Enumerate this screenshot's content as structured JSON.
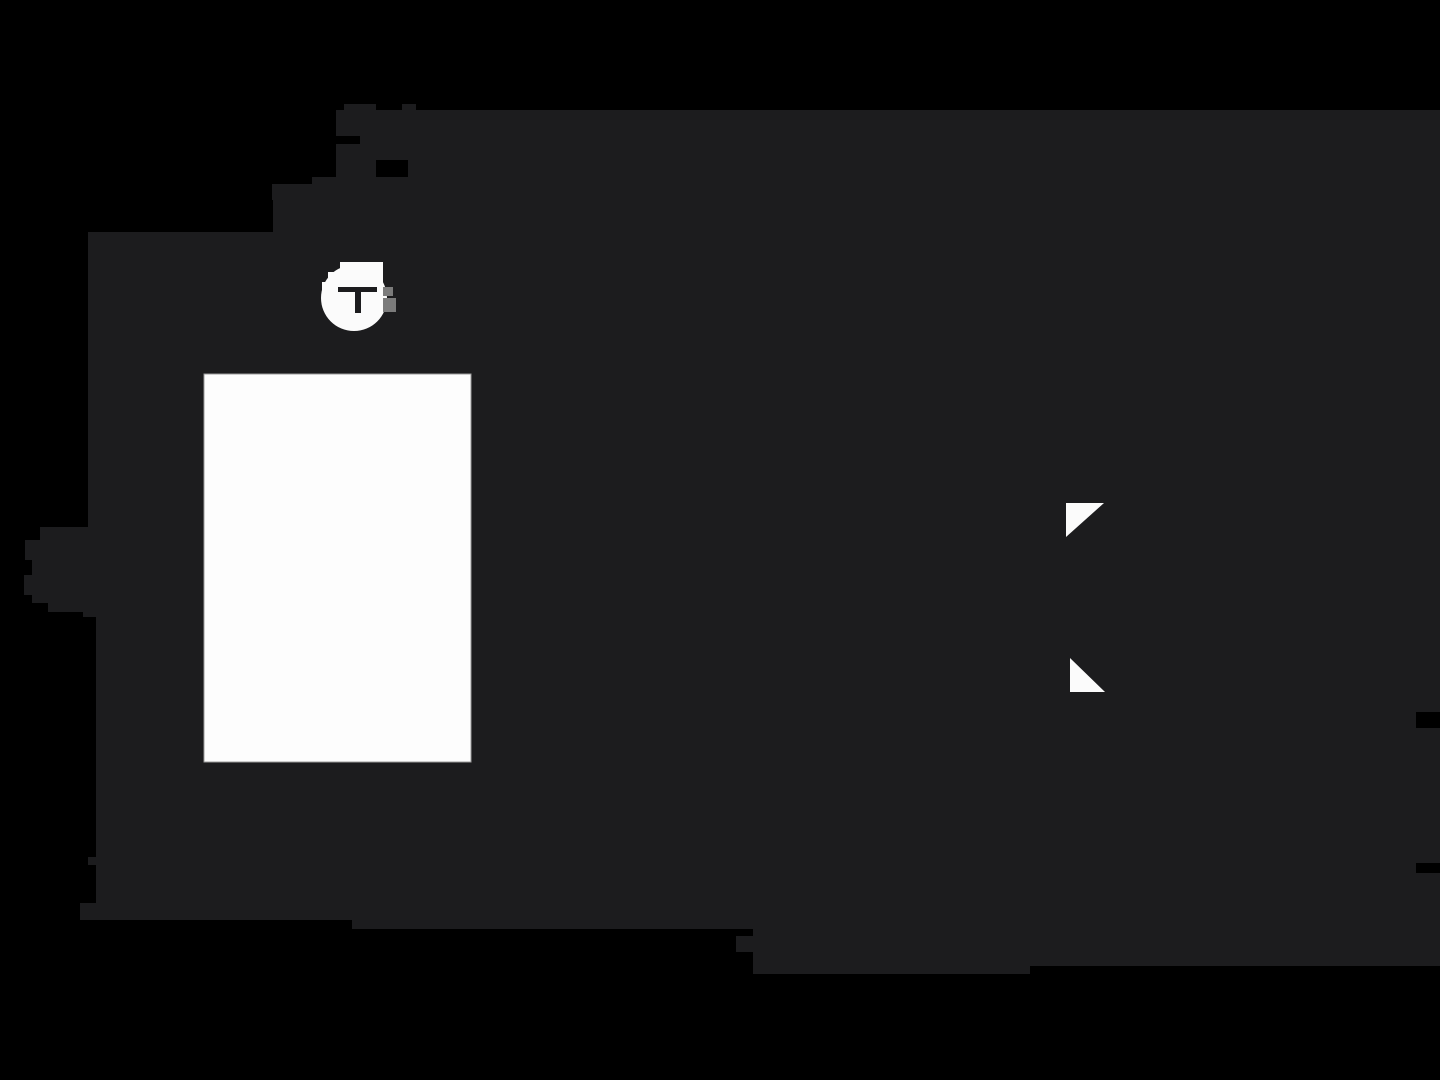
{
  "canvas": {
    "width": 1440,
    "height": 1080,
    "background": "#000000"
  },
  "colors": {
    "blob": "#1c1c1e",
    "white": "#fbfbfb",
    "panel_fill": "#fdfdfd",
    "panel_border": "#9a9a9a",
    "gray_pixel": "#7b7b7b",
    "glyph": "#1c1c1e"
  },
  "blob": {
    "path": "M336,110 H344 V104 H376 V110 H402 V104 H416 V110 H1440 V712 H1416 V728 H1440 V863 H1416 V873 H1440 V966 H1030 V974 H753 V952 H736 V936 H753 V929 H352 V920 H80 V903 H96 V865 H88 V857 H96 V617 H83 V612 H48 V603 H32 V595 H24 V575 H32 V560 H25 V540 H40 V527 H88 V232 H273 V200 H312 V177 H336 Z",
    "bar": {
      "x": 272,
      "y": 184,
      "width": 40,
      "height": 16
    },
    "notches": [
      {
        "x": 336,
        "y": 136,
        "width": 24,
        "height": 8
      },
      {
        "x": 376,
        "y": 160,
        "width": 32,
        "height": 17
      }
    ]
  },
  "panel": {
    "x": 204,
    "y": 374,
    "width": 267,
    "height": 388
  },
  "badge": {
    "letter": "T",
    "cx": 354,
    "cy": 298,
    "radius": 33,
    "steps": [
      {
        "x": 340,
        "y": 262,
        "width": 43,
        "height": 12
      },
      {
        "x": 328,
        "y": 272,
        "width": 55,
        "height": 12
      },
      {
        "x": 322,
        "y": 282,
        "width": 20,
        "height": 12
      }
    ],
    "gray_pixels": [
      {
        "x": 383,
        "y": 287,
        "width": 10,
        "height": 9
      },
      {
        "x": 383,
        "y": 298,
        "width": 13,
        "height": 14
      }
    ],
    "glyph": {
      "crossbar": {
        "x": 338,
        "y": 287,
        "width": 39,
        "height": 5
      },
      "stem": {
        "x": 355,
        "y": 287,
        "width": 6,
        "height": 26
      }
    }
  },
  "triangles": [
    {
      "points": "1066,503 1104,503 1066,537"
    },
    {
      "points": "1070,658 1070,692 1105,692"
    }
  ]
}
